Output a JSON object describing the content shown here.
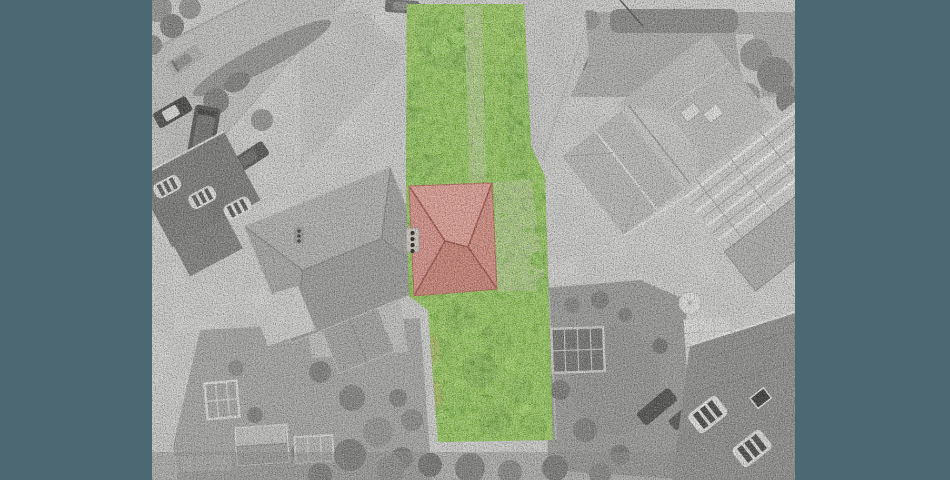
{
  "scene": {
    "kind": "aerial-drone-photo",
    "highlighted_region": "central-plot-in-full-colour",
    "highlight_contents": "front-garden-tree, garden-path, red-hip-roof-house, side-patio, overgrown-rear-garden, boundary-hedge",
    "desaturated_region": "surrounding-street, parked-cars, neighbour-houses, gardens, scaffolding"
  },
  "colors": {
    "backdrop": "#4c6872",
    "photo_base": "#d7d7d5",
    "road": "#c7c7c5",
    "pavement": "#d8d8d6",
    "lawn_gray": "#a9a9a7",
    "tree_gray": "#949492",
    "tree_gray_dark": "#7c7c7a",
    "roof_gray_light": "#bfbfbd",
    "roof_gray": "#a5a5a3",
    "roof_gray_dark": "#8e8e8c",
    "roof_dark": "#757573",
    "car_dark": "#3f3f3d",
    "white_detail": "#ececea",
    "plot_green": "#6fae35",
    "plot_green_dark": "#4f8a22",
    "plot_green_light": "#8cc94c",
    "hedge_green": "#57992b",
    "plot_path": "#b7b7ac",
    "plot_patio": "#b4b4aa",
    "tan_patch": "#b08a4e",
    "roof_red_light": "#dfa096",
    "roof_red": "#d6938a",
    "roof_red_mid": "#d28e82",
    "roof_red_deep": "#c98478",
    "roof_red_ridge": "#a2594f"
  }
}
